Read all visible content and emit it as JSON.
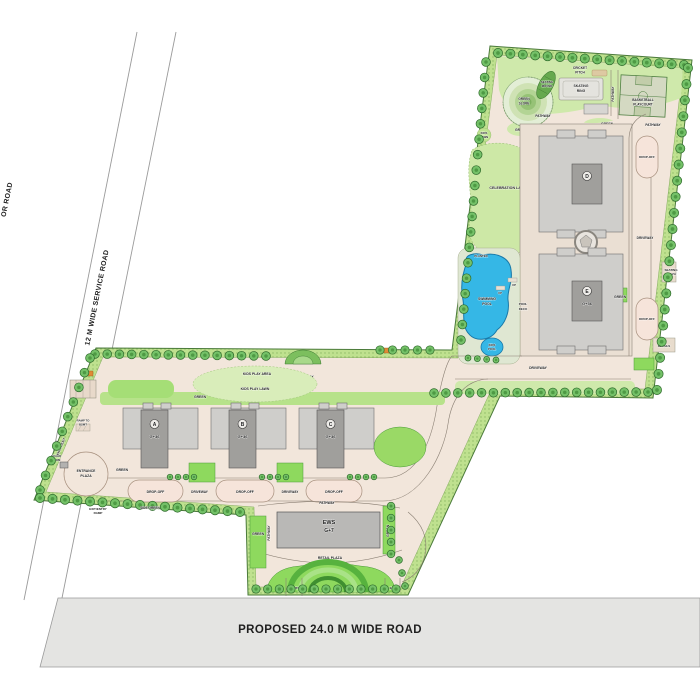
{
  "plan": {
    "roads": {
      "sector_road_fragment": "OR ROAD",
      "service_road": "12 M WIDE SERVICE ROAD",
      "proposed_road": "PROPOSED 24.0 M WIDE ROAD"
    },
    "entrance": {
      "main_entry_exit_l1": "MAIN",
      "main_entry_exit_l2": "ENTRY/EXIT",
      "entrance_plaza_l1": "ENTRANCE",
      "entrance_plaza_l2": "PLAZA",
      "guard_room_l1": "GUARD",
      "guard_room_l2": "ROOM",
      "ramp_l1": "RAMP TO",
      "ramp_l2": "BSMT",
      "exit_entry_ramp_l1": "EXIT/ENTRY",
      "exit_entry_ramp_l2": "RAMP",
      "entry": "ENTRY",
      "exit": "EXIT"
    },
    "circulation": {
      "drop_off": "DROP-OFF",
      "driveway": "DRIVEWAY",
      "pathway": "PATHWAY",
      "green": "GREEN",
      "side_green": "SIDE GREEN"
    },
    "amenities": {
      "kids_play_area": "KIDS PLAY AREA",
      "kids_play_lawn": "KIDS PLAY LAWN",
      "kids_lawn_l1": "KIDS",
      "kids_lawn_l2": "LAWN",
      "celebration_lawn": "CELEBRATION LAWN",
      "cricket_l1": "CRICKET",
      "cricket_l2": "PITCH",
      "skating_l1": "SKATING",
      "skating_l2": "RING",
      "basketball_l1": "BASKETBALL",
      "basketball_l2": "PLAYCOURT",
      "green_slope_l1": "GREEN",
      "green_slope_l2": "SLOPE",
      "seating_mound_l1": "SEATING",
      "seating_mound_l2": "MOUND",
      "swimming_pool_l1": "SWIMMING",
      "swimming_pool_l2": "POOL",
      "kids_pool_l1": "KIDS",
      "kids_pool_l2": "POOL",
      "pool_deck_l1": "POOL",
      "pool_deck_l2": "DECK",
      "up": "UP",
      "planter": "PLANTER",
      "seating_plaza_l1": "SEATING",
      "seating_plaza_l2": "PLAZA",
      "retails": "RETAILS",
      "retail_plaza": "RETAIL PLAZA",
      "retail_drop_off": "RETAIL/DROP-OFF"
    },
    "towers": {
      "a": {
        "letter": "A",
        "floors": "G+36"
      },
      "b": {
        "letter": "B",
        "floors": "G+36"
      },
      "c": {
        "letter": "C",
        "floors": "G+36"
      },
      "d": {
        "letter": "D"
      },
      "e": {
        "letter": "E",
        "floors": "G+36"
      },
      "ews": {
        "name": "EWS",
        "floors": "G+7"
      }
    },
    "colors": {
      "site_border_green": "#bfe18f",
      "lawn_green": "#8ed95e",
      "tree_green": "#5fae52",
      "road_cream": "#f2e6db",
      "pool_blue": "#35b7e6",
      "building_gray": "#a09f9c",
      "public_road_gray": "#e4e4e2"
    }
  }
}
